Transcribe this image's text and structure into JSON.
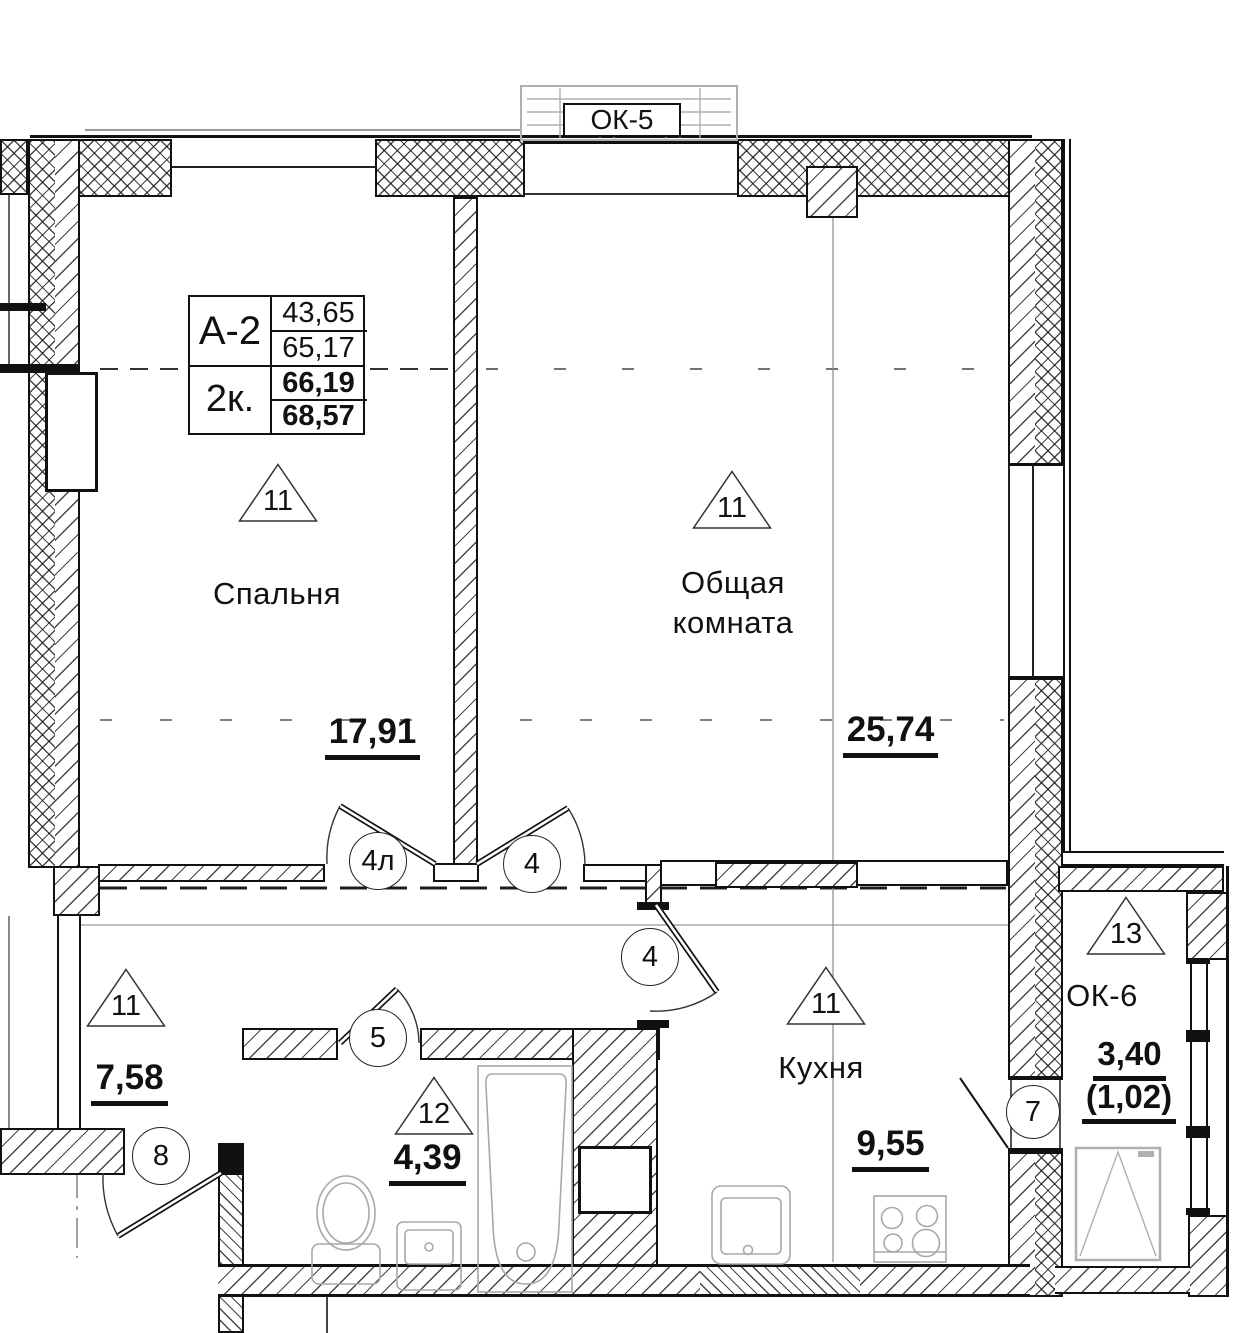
{
  "plan": {
    "ok5_label": "ОК-5",
    "info_table": {
      "type": "А-2",
      "rooms": "2к.",
      "v1": "43,65",
      "v2": "65,17",
      "v3": "66,19",
      "v4": "68,57"
    },
    "bedroom": {
      "zone": "11",
      "name": "Спальня",
      "area": "17,91"
    },
    "living": {
      "zone": "11",
      "name1": "Общая",
      "name2": "комната",
      "area": "25,74"
    },
    "hall": {
      "zone": "11",
      "area": "7,58"
    },
    "bath": {
      "zone": "12",
      "area": "4,39"
    },
    "kitchen": {
      "zone": "11",
      "name": "Кухня",
      "area": "9,55"
    },
    "balcony": {
      "zone": "13",
      "label": "ОК-6",
      "area": "3,40",
      "area2": "(1,02)"
    },
    "doors": {
      "bedroom": "4л",
      "living": "4",
      "kitchen": "4",
      "bath": "5",
      "entrance": "8",
      "balcony": "7"
    }
  }
}
